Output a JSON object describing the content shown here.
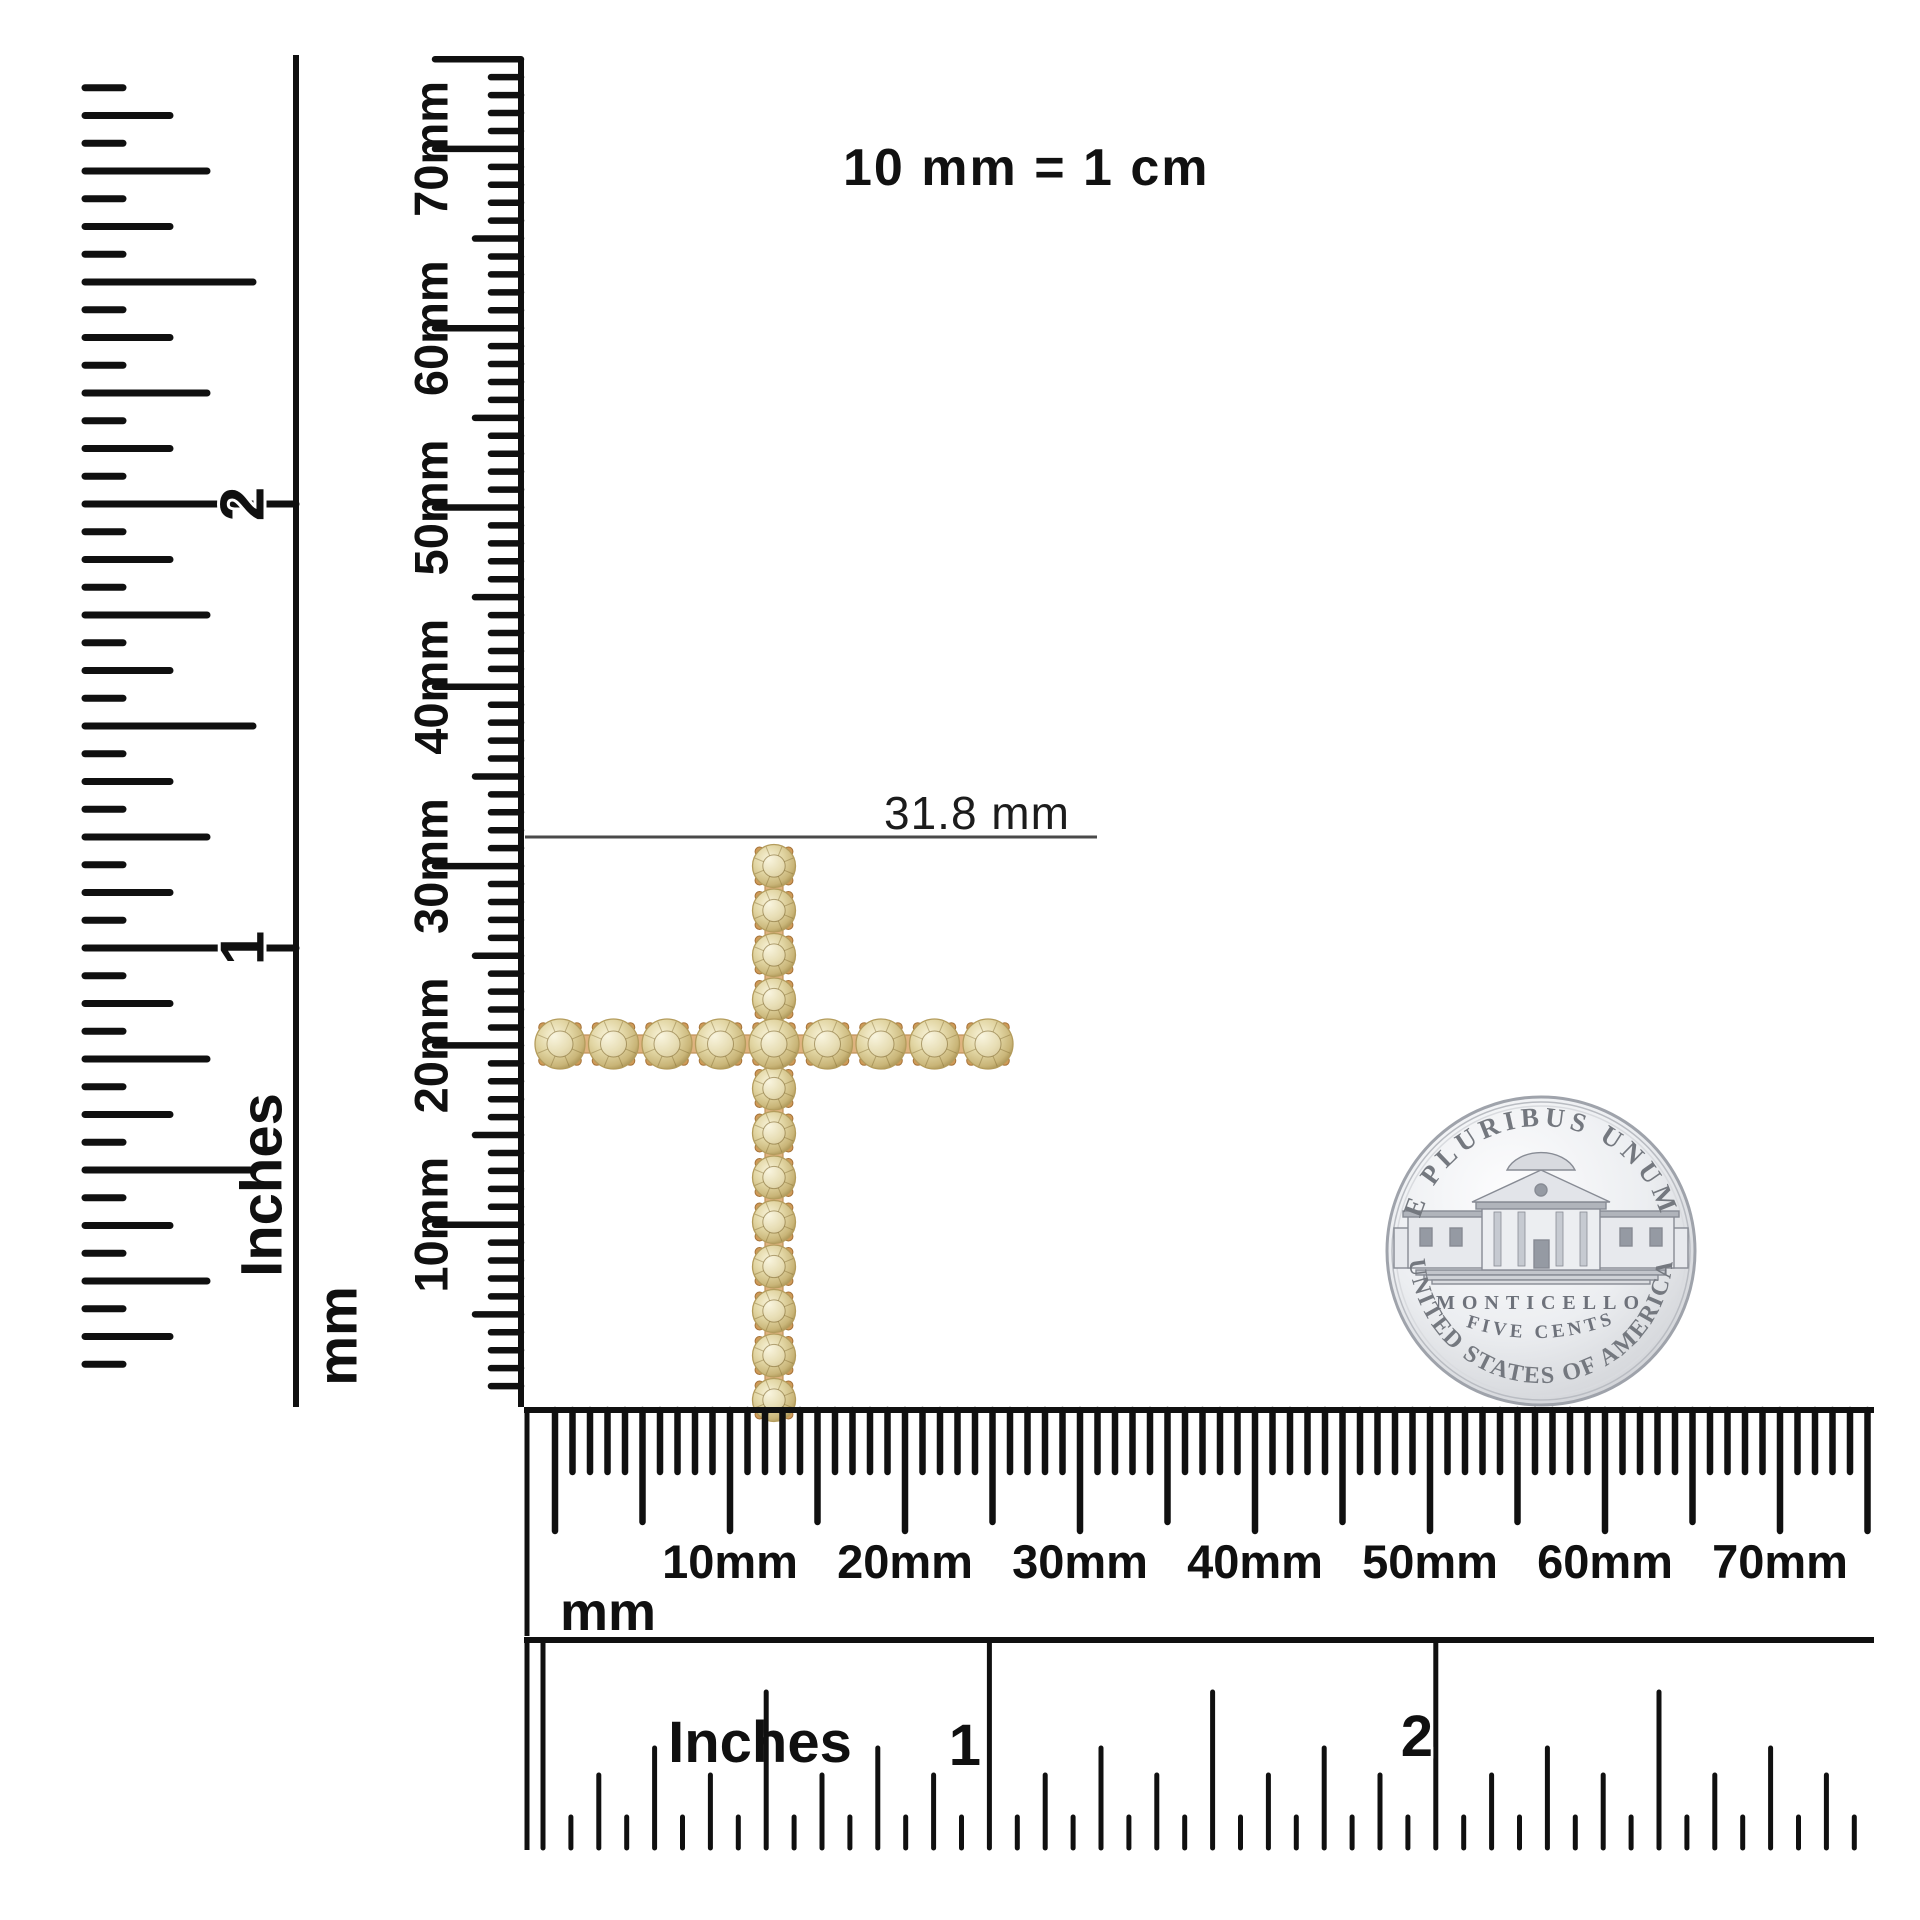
{
  "scene": {
    "equivalence_note": "10 mm = 1 cm",
    "background": "#ffffff"
  },
  "measurement": {
    "label": "31.8 mm",
    "value": "31.8",
    "unit": "mm"
  },
  "rulers": {
    "left_inches": {
      "unit_label": "Inches",
      "inch_marks": [
        "1",
        "2"
      ]
    },
    "vertical_mm": {
      "unit_label": "mm",
      "marks": [
        "10mm",
        "20mm",
        "30mm",
        "40mm",
        "50mm",
        "60mm",
        "70mm"
      ]
    },
    "bottom_mm": {
      "unit_label": "mm",
      "marks": [
        "10mm",
        "20mm",
        "30mm",
        "40mm",
        "50mm",
        "60mm",
        "70mm"
      ]
    },
    "bottom_inches": {
      "unit_label": "Inches",
      "inch_marks": [
        "1",
        "2"
      ]
    }
  },
  "coin": {
    "name": "Jefferson nickel reverse",
    "top_legend": "E PLURIBUS UNUM",
    "building_label": "MONTICELLO",
    "denomination": "FIVE CENTS",
    "bottom_legend": "UNITED STATES OF AMERICA"
  },
  "pendant": {
    "description": "champagne diamond cross pendant",
    "stones_vertical": 13,
    "stones_horizontal": 9,
    "stones_total": 21,
    "stone_color": "#d8c98f",
    "metal_color": "#cf9a58"
  },
  "colors": {
    "ruler_ink": "#101010",
    "measure_line": "#4a4a4a",
    "coin_silver": "#e9ebee",
    "coin_text": "#73777f"
  }
}
